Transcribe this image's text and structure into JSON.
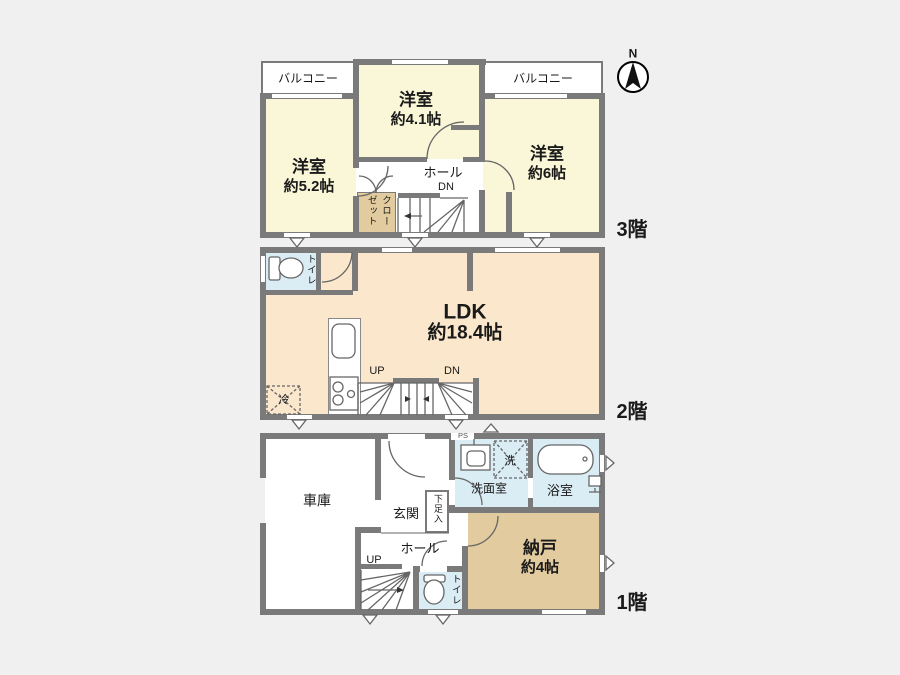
{
  "colors": {
    "background": "#f0f0f0",
    "wall": "#7a7a7a",
    "room_cream": "#faf6d8",
    "room_peach": "#fbe8cc",
    "room_tan": "#e2cb9e",
    "room_blue": "#daedf4",
    "linework": "#666666"
  },
  "compass": {
    "north_label": "N"
  },
  "floor3": {
    "label": "3階",
    "balcony_left": "バルコニー",
    "balcony_right": "バルコニー",
    "room_center_name": "洋室",
    "room_center_size": "約4.1帖",
    "room_left_name": "洋室",
    "room_left_size": "約5.2帖",
    "room_right_name": "洋室",
    "room_right_size": "約6帖",
    "hall_label": "ホール",
    "dn_label": "DN",
    "closet_label": "クローゼット"
  },
  "floor2": {
    "label": "2階",
    "toilet_label": "トイレ",
    "ldk_name": "LDK",
    "ldk_size": "約18.4帖",
    "fridge_label": "冷",
    "up_label": "UP",
    "dn_label": "DN"
  },
  "floor1": {
    "label": "1階",
    "garage_label": "車庫",
    "entrance_label": "玄関",
    "shoe_cabinet_label": "下足入",
    "hall_label": "ホール",
    "up_label": "UP",
    "toilet_label": "トイレ",
    "storage_name": "納戸",
    "storage_size": "約4帖",
    "washroom_label": "洗面室",
    "washer_label": "洗",
    "bathroom_label": "浴室",
    "pipe_space_label": "PS"
  }
}
